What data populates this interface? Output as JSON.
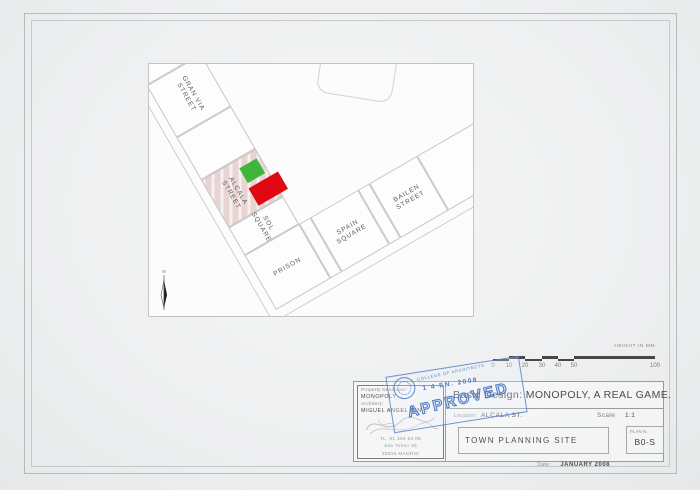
{
  "map": {
    "cells": {
      "gran_via": {
        "line1": "GRAN VIA",
        "line2": "STREET"
      },
      "alcala": {
        "line1": "ALCALA",
        "line2": "STREET"
      },
      "sol": {
        "line1": "SOL",
        "line2": "SQUARE"
      },
      "spain": {
        "line1": "SPAIN",
        "line2": "SQUARE"
      },
      "bailen": {
        "line1": "BAILEN",
        "line2": "STREET"
      },
      "prison": {
        "label": "PRISON"
      }
    },
    "north_label": "N",
    "colors": {
      "parcel_highlight": "#e9d3d3",
      "house_green": "#3fb53a",
      "hotel_red": "#e00813"
    }
  },
  "scalebar": {
    "caption": "HEIGHT IN MM.",
    "ticks": [
      "0",
      "10",
      "20",
      "30",
      "40",
      "50",
      "100"
    ]
  },
  "titleblock": {
    "developer_label": "Property Developer:",
    "developer": "MONOPOLY",
    "architect_label": "Architect:",
    "architect": "MIGUEL ANGEL MIN...",
    "phone": "TL. 91 394 53 05",
    "address_line1": "San Telmo 36",
    "address_line2": "28016 MADRID",
    "main_title": "Basic Design:  MONOPOLY, A REAL GAME.",
    "location_label": "Location:",
    "location": "ALCALA ST.",
    "scale_label": "Scale",
    "scale": "1:1",
    "drawing_name": "TOWN PLANNING SITE",
    "plan_label": "PLAN N:",
    "plan_number": "B0-S",
    "date_label": "Date:",
    "date": "JANUARY 2008"
  },
  "stamp": {
    "org": "COLLEGE OF ARCHITECTS",
    "date": "1 4 EN. 2008",
    "text": "APPROVED",
    "color": "#4c7ac4"
  }
}
